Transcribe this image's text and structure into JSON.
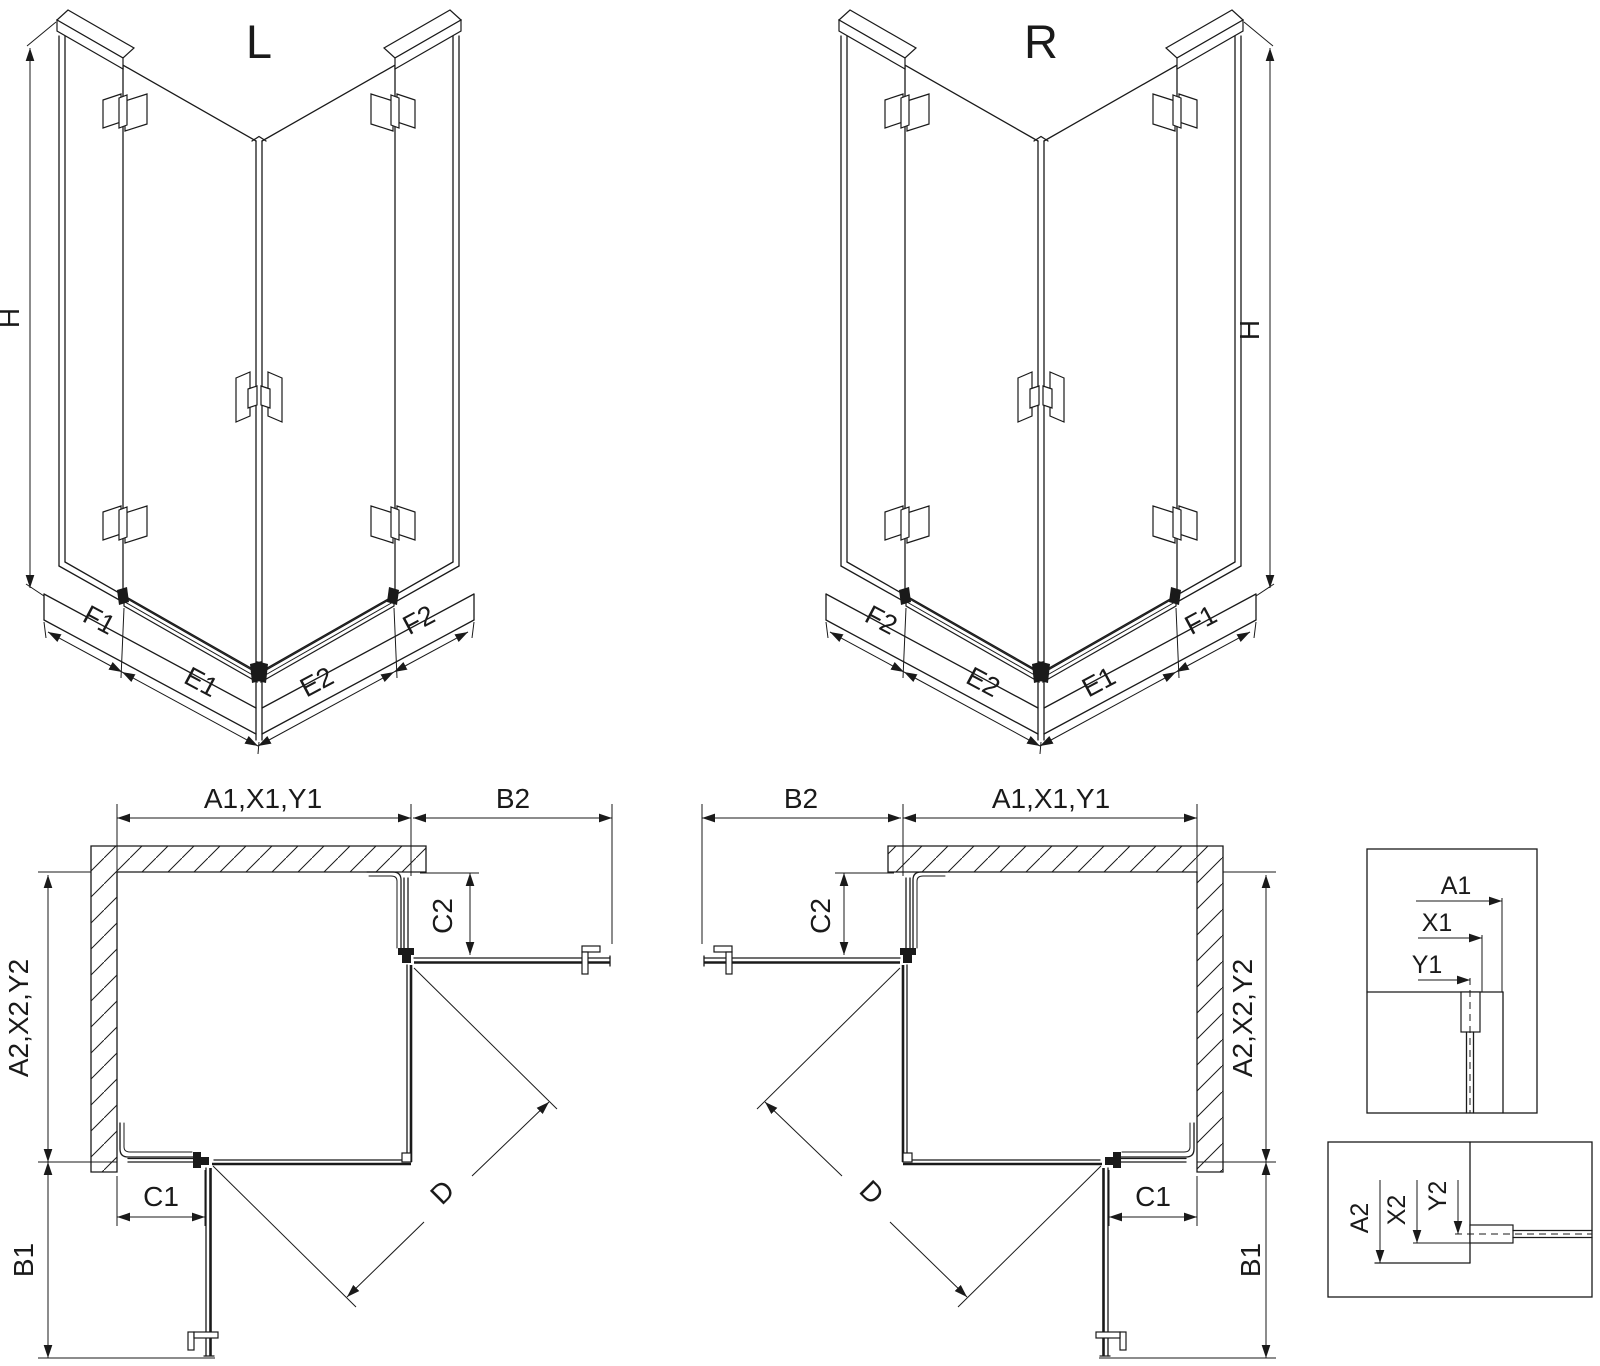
{
  "drawing": {
    "background": "#ffffff",
    "ink": "#1a1a1a"
  },
  "iso_left": {
    "view_label": "L",
    "height_label": "H",
    "seg_labels": [
      "F1",
      "E1",
      "E2",
      "F2"
    ]
  },
  "iso_right": {
    "view_label": "R",
    "height_label": "H",
    "seg_labels": [
      "F2",
      "E2",
      "E1",
      "F1"
    ]
  },
  "plan_left": {
    "width_label": "A1,X1,Y1",
    "door_width_label": "B2",
    "fixed_top_label": "C2",
    "depth_label": "A2,X2,Y2",
    "fixed_side_label": "C1",
    "door_depth_label": "B1",
    "diagonal_label": "D"
  },
  "plan_right": {
    "width_label": "A1,X1,Y1",
    "door_width_label": "B2",
    "fixed_top_label": "C2",
    "depth_label": "A2,X2,Y2",
    "fixed_side_label": "C1",
    "door_depth_label": "B1",
    "diagonal_label": "D"
  },
  "detail_top": {
    "labels": [
      "A1",
      "X1",
      "Y1"
    ]
  },
  "detail_bottom": {
    "labels": [
      "A2",
      "X2",
      "Y2"
    ]
  }
}
